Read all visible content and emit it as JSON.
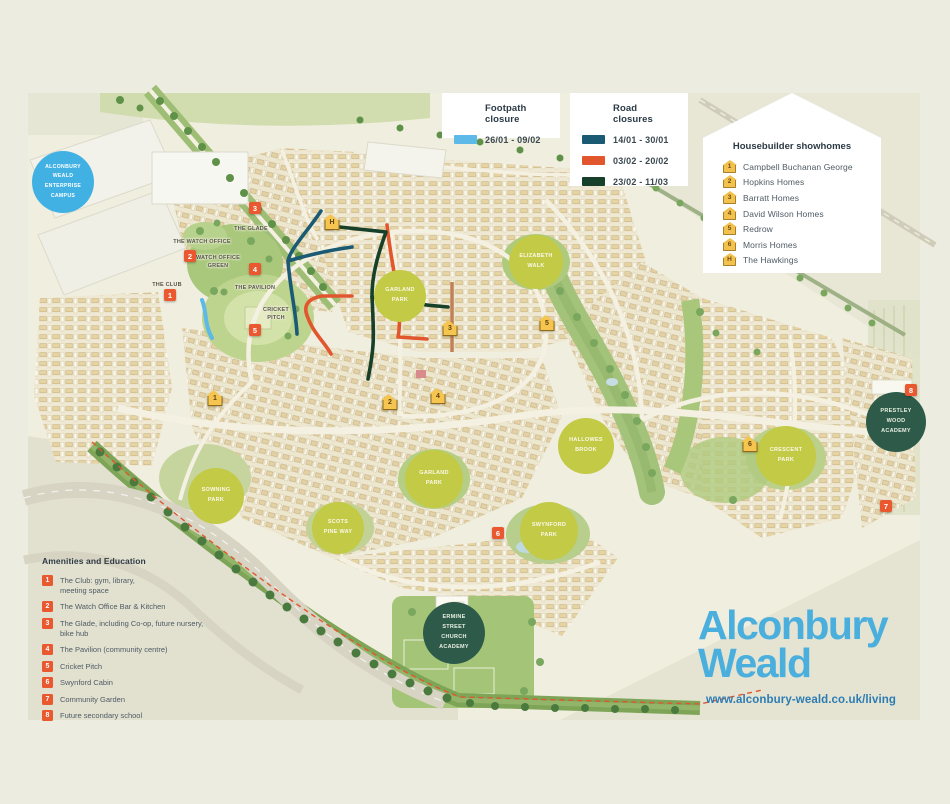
{
  "legend_footpath": {
    "title": "Footpath closure",
    "items": [
      {
        "label": "26/01 - 09/02",
        "color": "#5CB9E8"
      }
    ]
  },
  "legend_road": {
    "title": "Road closures",
    "items": [
      {
        "label": "14/01 - 30/01",
        "color": "#1A5A72"
      },
      {
        "label": "03/02 - 20/02",
        "color": "#E2562E"
      },
      {
        "label": "23/02 - 11/03",
        "color": "#17402B"
      }
    ]
  },
  "showhomes": {
    "title": "Housebuilder showhomes",
    "icon_color": "#F2C14E",
    "items": [
      {
        "num": "1",
        "name": "Campbell Buchanan George"
      },
      {
        "num": "2",
        "name": "Hopkins Homes"
      },
      {
        "num": "3",
        "name": "Barratt Homes"
      },
      {
        "num": "4",
        "name": "David Wilson Homes"
      },
      {
        "num": "5",
        "name": "Redrow"
      },
      {
        "num": "6",
        "name": "Morris Homes"
      },
      {
        "num": "H",
        "name": "The Hawkings"
      }
    ]
  },
  "amenities": {
    "title": "Amenities and Education",
    "marker_color": "#E9582F",
    "items": [
      {
        "num": "1",
        "name": "The Club: gym, library,\nmeeting space"
      },
      {
        "num": "2",
        "name": "The Watch Office Bar & Kitchen"
      },
      {
        "num": "3",
        "name": "The Glade, including Co-op, future nursery,\nbike hub"
      },
      {
        "num": "4",
        "name": "The Pavilion (community centre)"
      },
      {
        "num": "5",
        "name": "Cricket Pitch"
      },
      {
        "num": "6",
        "name": "Swynford Cabin"
      },
      {
        "num": "7",
        "name": "Community Garden"
      },
      {
        "num": "8",
        "name": "Future secondary school"
      }
    ]
  },
  "map_labels": {
    "campus": "ALCONBURY\nWEALD\nENTERPRISE\nCAMPUS",
    "watch_office": "THE WATCH OFFICE",
    "watch_office_green": "WATCH OFFICE\nGREEN",
    "glade": "THE GLADE",
    "club": "THE CLUB",
    "pavilion": "THE PAVILION",
    "cricket_pitch": "CRICKET\nPITCH",
    "elizabeth_walk": "ELIZABETH\nWALK",
    "garland_park_upper": "GARLAND\nPARK",
    "garland_park": "GARLAND\nPARK",
    "sowning_park": "SOWNING\nPARK",
    "scots_pine_way": "SCOTS\nPINE WAY",
    "swynford_park": "SWYNFORD\nPARK",
    "hallowes_brook": "HALLOWES\nBROOK",
    "crescent_park": "CRESCENT\nPARK",
    "prestley_wood_academy": "PRESTLEY\nWOOD\nACADEMY",
    "ermine_street_academy": "ERMINE\nSTREET\nCHURCH\nACADEMY"
  },
  "colors": {
    "page_bg": "#ECEDE0",
    "footpath_closure": "#5CB9E8",
    "road_closure_1": "#1A5A72",
    "road_closure_2": "#E2562E",
    "road_closure_3": "#17402B",
    "amenity_marker": "#E9582F",
    "showhome_marker": "#F2C14E",
    "park_circle": "#C3CA46",
    "academy_circle": "#2E5B49",
    "campus_circle": "#41B1E3",
    "brand_blue": "#4BAFDE",
    "url_blue": "#2C7CB4"
  },
  "branding": {
    "name_line1": "Alconbury",
    "name_line2": "Weald",
    "url": "www.alconbury-weald.co.uk/living"
  }
}
